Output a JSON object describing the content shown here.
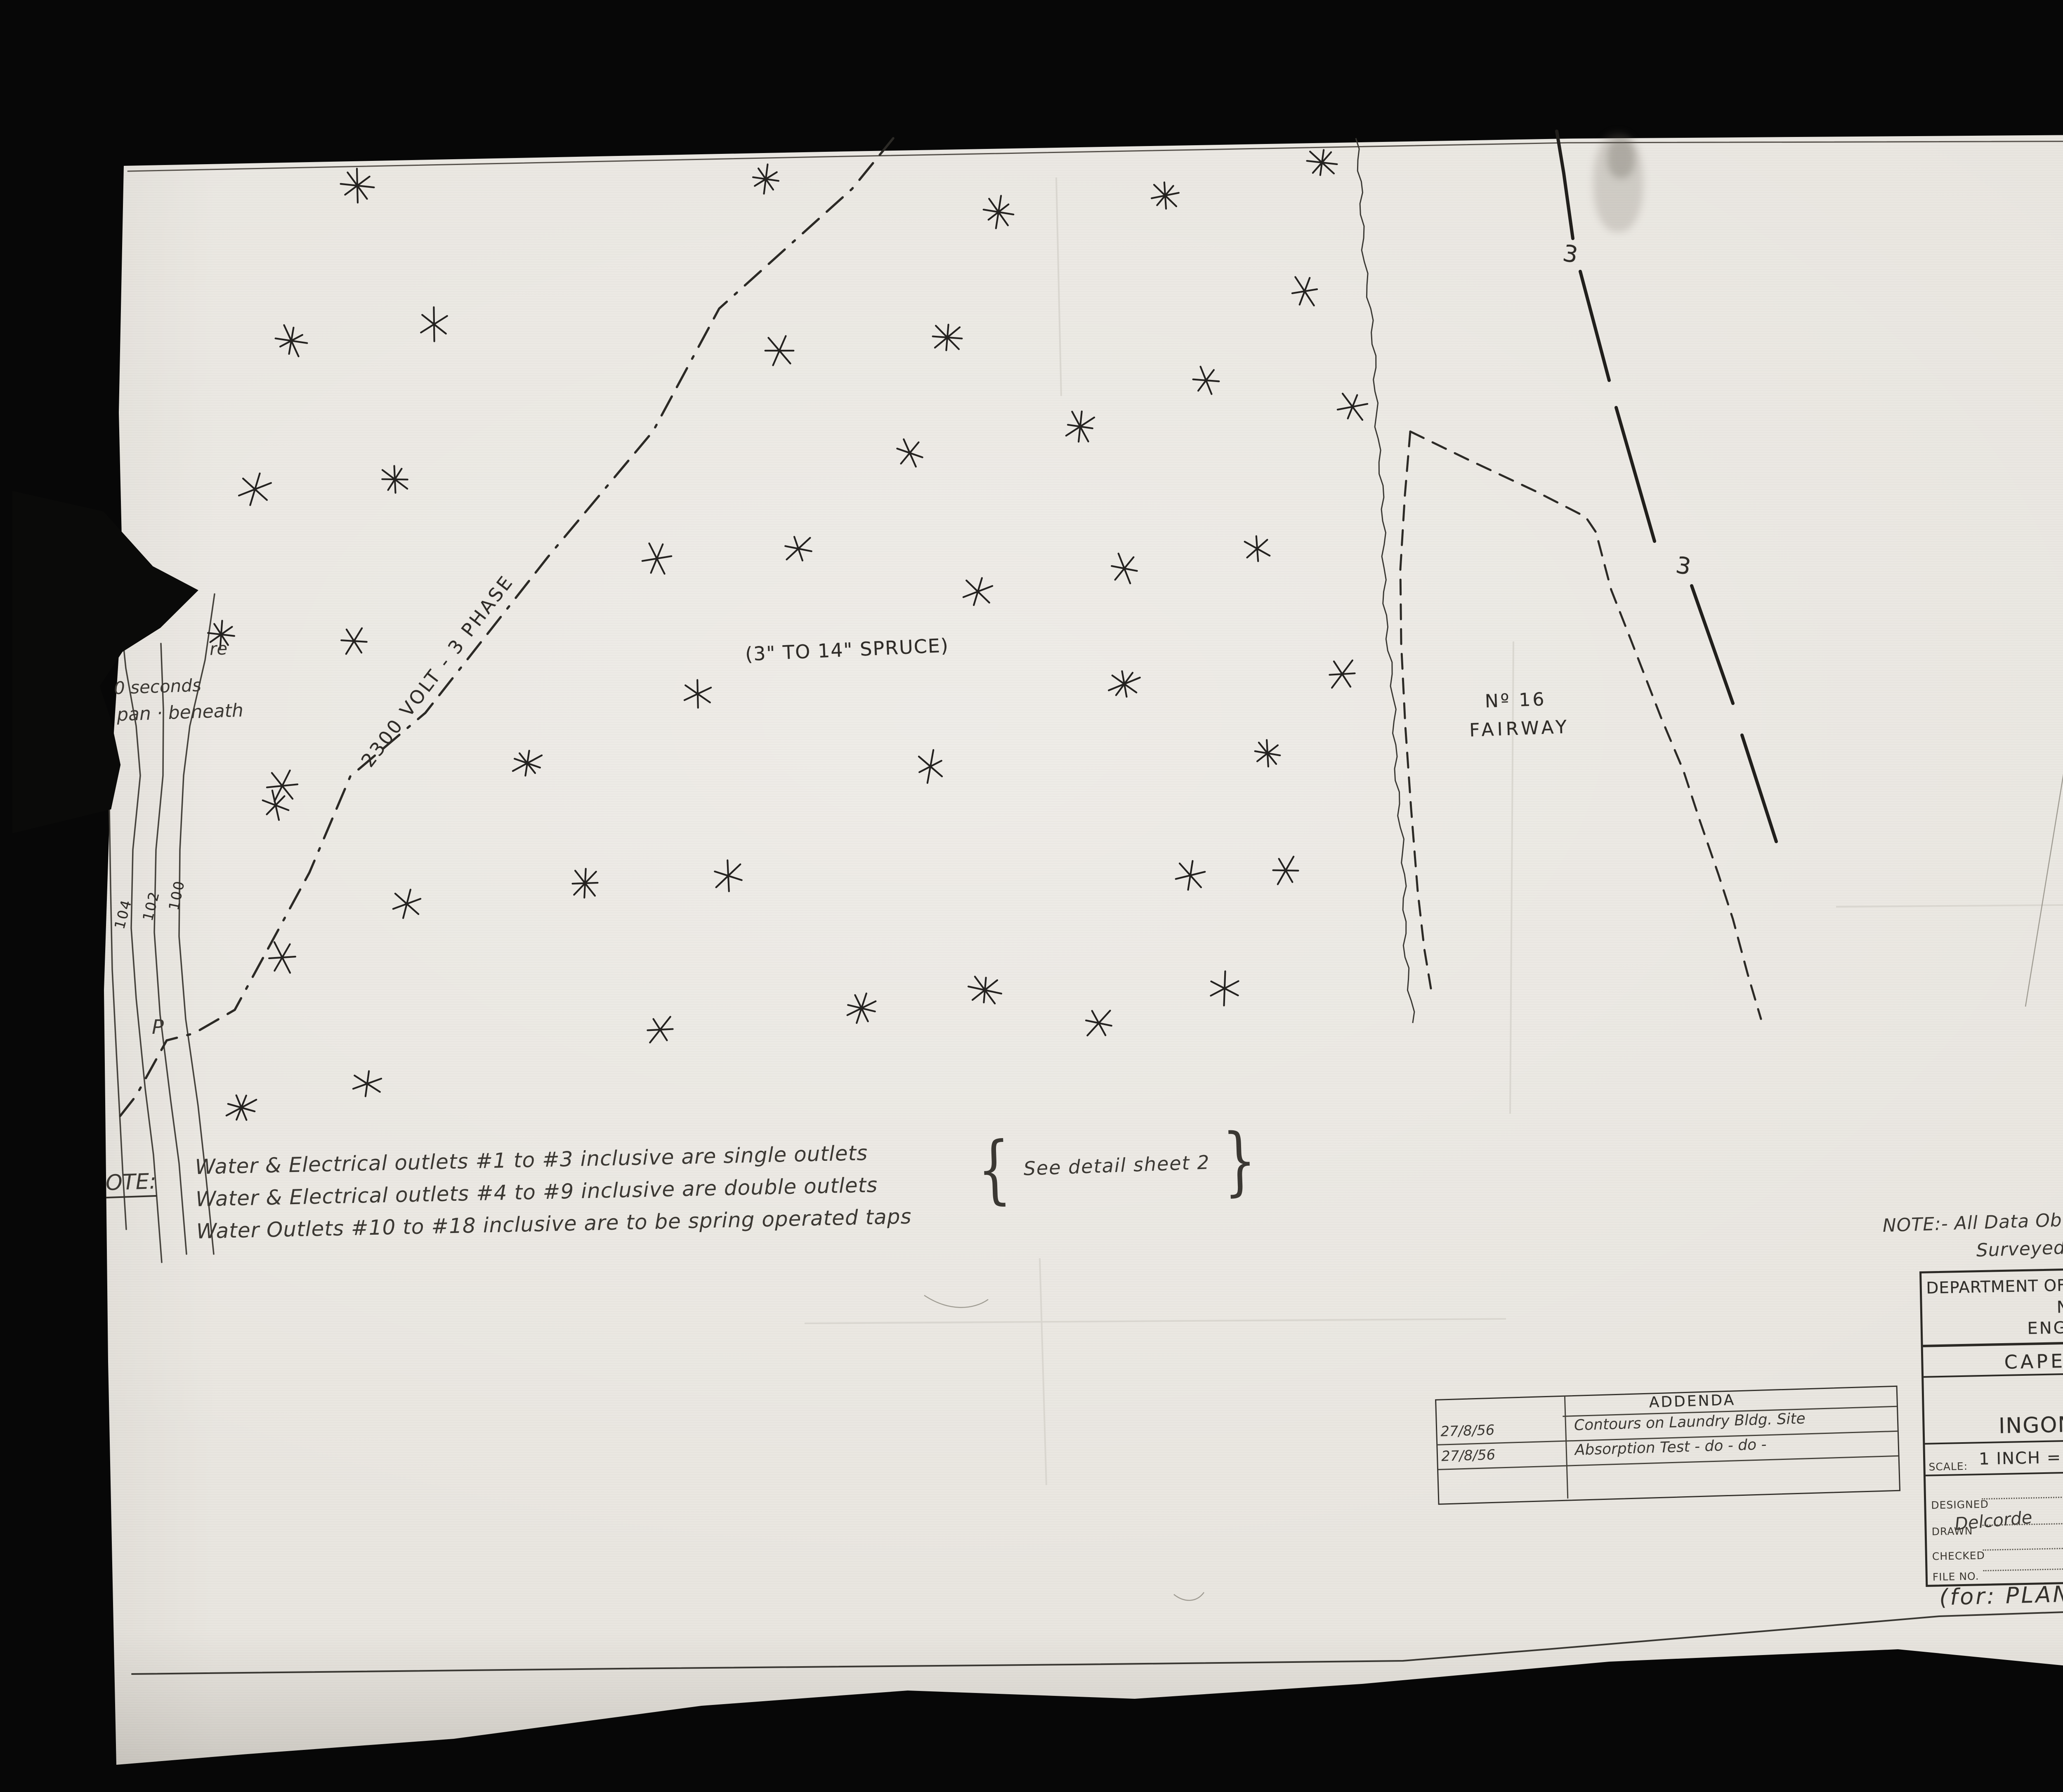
{
  "colors": {
    "paper": "#e9e6e0",
    "ink": "#2b2925",
    "hand_ink": "#3b3833",
    "black": "#070707",
    "badge_bg": "#f6f5f1"
  },
  "stamps": {
    "page_count": "4  OF/DE  4",
    "repeat_line1": "REPEAT/",
    "repeat_line2": "RÉPÉTITION"
  },
  "map": {
    "power_line_label": "2300 VOLT - 3 PHASE",
    "spruce_label": "(3\" TO 14\" SPRUCE)",
    "fairway_label_line1": "Nº 16",
    "fairway_label_line2": "FAIRWAY",
    "wire_label": "3",
    "pole_label": "P",
    "contour_labels": [
      "104",
      "102",
      "100"
    ],
    "edge_note_line1": "re",
    "edge_note_line2": "0 seconds",
    "edge_note_line3": "pan · beneath",
    "trees": [
      [
        866,
        450
      ],
      [
        1856,
        434
      ],
      [
        2420,
        514
      ],
      [
        2824,
        474
      ],
      [
        3204,
        394
      ],
      [
        1052,
        786
      ],
      [
        706,
        826
      ],
      [
        1889,
        850
      ],
      [
        2296,
        818
      ],
      [
        3162,
        706
      ],
      [
        618,
        1186
      ],
      [
        957,
        1162
      ],
      [
        2205,
        1098
      ],
      [
        2618,
        1034
      ],
      [
        2923,
        922
      ],
      [
        3278,
        986
      ],
      [
        536,
        1538
      ],
      [
        858,
        1554
      ],
      [
        1592,
        1354
      ],
      [
        1935,
        1330
      ],
      [
        2370,
        1434
      ],
      [
        2725,
        1378
      ],
      [
        3047,
        1330
      ],
      [
        684,
        1905
      ],
      [
        1278,
        1850
      ],
      [
        1691,
        1682
      ],
      [
        2255,
        1858
      ],
      [
        2725,
        1658
      ],
      [
        3253,
        1634
      ],
      [
        3072,
        1826
      ],
      [
        668,
        1952
      ],
      [
        986,
        2191
      ],
      [
        1418,
        2141
      ],
      [
        1765,
        2123
      ],
      [
        2885,
        2122
      ],
      [
        3116,
        2110
      ],
      [
        684,
        2321
      ],
      [
        1600,
        2496
      ],
      [
        2088,
        2444
      ],
      [
        2387,
        2400
      ],
      [
        2663,
        2480
      ],
      [
        2968,
        2396
      ],
      [
        585,
        2685
      ],
      [
        890,
        2627
      ]
    ],
    "geometry": {
      "power_line": {
        "points": [
          [
            2165,
            335
          ],
          [
            2065,
            458
          ],
          [
            1743,
            748
          ],
          [
            1583,
            1045
          ],
          [
            1328,
            1350
          ],
          [
            1031,
            1728
          ],
          [
            849,
            1882
          ],
          [
            750,
            2115
          ],
          [
            569,
            2448
          ],
          [
            470,
            2505
          ],
          [
            404,
            2522
          ],
          [
            330,
            2656
          ],
          [
            286,
            2712
          ]
        ],
        "dash": "52 26 52 26 7 26",
        "width": 5.5
      },
      "creek": {
        "points": [
          [
            3286,
            335
          ],
          [
            3300,
            520
          ],
          [
            3318,
            720
          ],
          [
            3332,
            920
          ],
          [
            3346,
            1120
          ],
          [
            3352,
            1320
          ],
          [
            3362,
            1520
          ],
          [
            3376,
            1720
          ],
          [
            3390,
            1920
          ],
          [
            3400,
            2120
          ],
          [
            3410,
            2320
          ],
          [
            3423,
            2480
          ]
        ],
        "width": 3
      },
      "fairway_left": {
        "points": [
          [
            3418,
            1046
          ],
          [
            3405,
            1200
          ],
          [
            3394,
            1380
          ],
          [
            3396,
            1560
          ],
          [
            3406,
            1760
          ],
          [
            3420,
            1960
          ],
          [
            3436,
            2160
          ],
          [
            3452,
            2300
          ],
          [
            3468,
            2396
          ]
        ],
        "dash": "36 24",
        "width": 5
      },
      "fairway_right": {
        "points": [
          [
            3418,
            1046
          ],
          [
            3560,
            1115
          ],
          [
            3720,
            1190
          ],
          [
            3843,
            1253
          ],
          [
            3868,
            1290
          ],
          [
            3905,
            1430
          ],
          [
            3953,
            1552
          ],
          [
            4026,
            1740
          ],
          [
            4080,
            1868
          ],
          [
            4120,
            1990
          ],
          [
            4165,
            2120
          ],
          [
            4200,
            2228
          ],
          [
            4236,
            2362
          ],
          [
            4268,
            2470
          ]
        ],
        "dash": "36 24",
        "width": 5
      },
      "boundary_segments": [
        [
          [
            3773,
            318
          ],
          [
            3790,
            420
          ],
          [
            3812,
            578
          ]
        ],
        [
          [
            3830,
            658
          ],
          [
            3900,
            922
          ]
        ],
        [
          [
            3917,
            988
          ],
          [
            4010,
            1312
          ]
        ],
        [
          [
            4100,
            1420
          ],
          [
            4200,
            1705
          ]
        ],
        [
          [
            4222,
            1782
          ],
          [
            4305,
            2040
          ]
        ]
      ],
      "contours": [
        [
          [
            285,
            1430
          ],
          [
            305,
            1620
          ],
          [
            330,
            1760
          ],
          [
            340,
            1880
          ],
          [
            322,
            2060
          ],
          [
            318,
            2250
          ],
          [
            330,
            2420
          ],
          [
            352,
            2640
          ],
          [
            372,
            2800
          ],
          [
            392,
            3060
          ]
        ],
        [
          [
            390,
            1560
          ],
          [
            396,
            1720
          ],
          [
            395,
            1880
          ],
          [
            378,
            2060
          ],
          [
            374,
            2260
          ],
          [
            388,
            2460
          ],
          [
            414,
            2670
          ],
          [
            434,
            2820
          ],
          [
            452,
            3040
          ]
        ],
        [
          [
            520,
            1440
          ],
          [
            497,
            1600
          ],
          [
            460,
            1760
          ],
          [
            445,
            1880
          ],
          [
            436,
            2060
          ],
          [
            434,
            2270
          ],
          [
            450,
            2470
          ],
          [
            480,
            2680
          ],
          [
            500,
            2860
          ],
          [
            518,
            3040
          ]
        ],
        [
          [
            265,
            1960
          ],
          [
            268,
            2150
          ],
          [
            272,
            2350
          ],
          [
            282,
            2550
          ],
          [
            290,
            2700
          ],
          [
            298,
            2850
          ],
          [
            306,
            2980
          ]
        ]
      ],
      "border_top": [
        [
          310,
          415
        ],
        [
          2000,
          380
        ],
        [
          3800,
          346
        ],
        [
          5963,
          340
        ]
      ],
      "border_right": [
        [
          5963,
          340
        ],
        [
          5990,
          1000
        ],
        [
          5998,
          2000
        ],
        [
          5995,
          2600
        ],
        [
          5975,
          3300
        ],
        [
          5953,
          3892
        ]
      ],
      "border_bottom": [
        [
          320,
          4058
        ],
        [
          1500,
          4045
        ],
        [
          2600,
          4035
        ],
        [
          3400,
          4026
        ],
        [
          3750,
          3998
        ],
        [
          4300,
          3952
        ],
        [
          4700,
          3918
        ],
        [
          5000,
          3908
        ],
        [
          5953,
          3892
        ]
      ],
      "creases": [
        [
          2520,
          3050,
          2536,
          3600
        ],
        [
          3668,
          1555,
          3660,
          2700
        ],
        [
          2560,
          430,
          2572,
          960
        ],
        [
          1950,
          3208,
          3650,
          3197
        ],
        [
          4450,
          2198,
          6080,
          2186
        ]
      ],
      "scratches": [
        "M5030,1700 C4990,1950 4950,2200 4909,2440",
        "M2845,3865 C2870,3885 2900,3885 2918,3860",
        "M2240,3140 C2300,3180 2360,3175 2395,3150"
      ]
    }
  },
  "notes": {
    "left": {
      "label": "OTE:",
      "line1": "Water & Electrical outlets #1 to #3 inclusive are single outlets",
      "line2": "Water & Electrical outlets #4 to #9 inclusive are double outlets",
      "line3": "Water Outlets #10 to #18 inclusive are to be spring operated taps",
      "brace_open": "{",
      "brace_note": "See detail sheet 2",
      "brace_close": "}"
    },
    "data_note_line1": "NOTE:- All Data Obtained From Drawing Nº: C.B.H-13-37",
    "data_note_line2": "Surveyed by: J.C.B. - October - 1951."
  },
  "addenda": {
    "title": "ADDENDA",
    "rows": [
      {
        "date": "27/8/56",
        "text": "Contours on Laundry Bldg. Site"
      },
      {
        "date": "27/8/56",
        "text": "Absorption Test - do - do -"
      }
    ]
  },
  "title_block": {
    "dept": "DEPARTMENT OF NORTHERN AFFAIRS & NATIONAL RESOURCES",
    "branch": "NATIONAL PARKS BRANCH",
    "division": "ENGINEERING SERVICES DIVISION",
    "park": "CAPE BRETON HIGHLANDS",
    "title1": "DEVELOPMENT AREA",
    "title2": "INGONISH BEACH-CAMPGROUNDS",
    "scale_label": "SCALE:",
    "scale_value": "1 INCH = 50 FT.",
    "date_label": "DATE:",
    "date_value": "MARCH 26th /1956",
    "designed_label": "DESIGNED",
    "drawn_label": "DRAWN",
    "drawn_value": "Delcorde",
    "checked_label": "CHECKED",
    "file_label": "FILE NO.",
    "approved_label": "APPROVED",
    "chief_label": "CHIEF ENGINEER",
    "index_label": "INDEX NO.",
    "index_value_line1": "C.B.H.",
    "index_value_line2": "35",
    "sheet_label": "SHEET NO.",
    "sheet_value": "1/3",
    "plan_ref": "(for:  PLAN  C.B.H. 51)"
  }
}
